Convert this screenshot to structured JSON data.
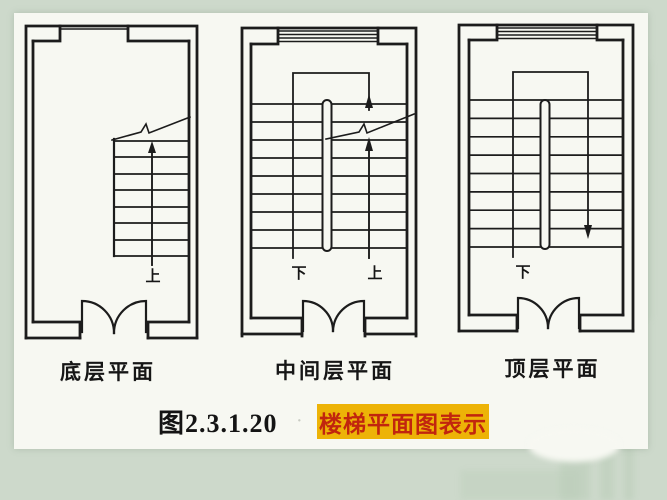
{
  "slide": {
    "background_color": "#cdd9cb",
    "paper_color": "#f7f8f2",
    "ink_color": "#1c1c1c"
  },
  "panels": [
    {
      "id": "ground-floor",
      "label": "底层平面",
      "up_label": "上"
    },
    {
      "id": "middle-floor",
      "label": "中间层平面",
      "up_label": "上",
      "down_label": "下"
    },
    {
      "id": "top-floor",
      "label": "顶层平面",
      "down_label": "下"
    }
  ],
  "caption": {
    "figure_number": "图2.3.1.20",
    "highlight_text": "楼梯平面图表示",
    "highlight_background": "#edb307",
    "highlight_text_color": "#c1250e"
  },
  "icons": {
    "up_arrow": "up-direction-arrow",
    "down_arrow": "down-direction-arrow",
    "break_line": "break-line-icon",
    "door": "double-door-swing-icon",
    "window": "window-symbol",
    "handrail": "handrail-symbol"
  }
}
